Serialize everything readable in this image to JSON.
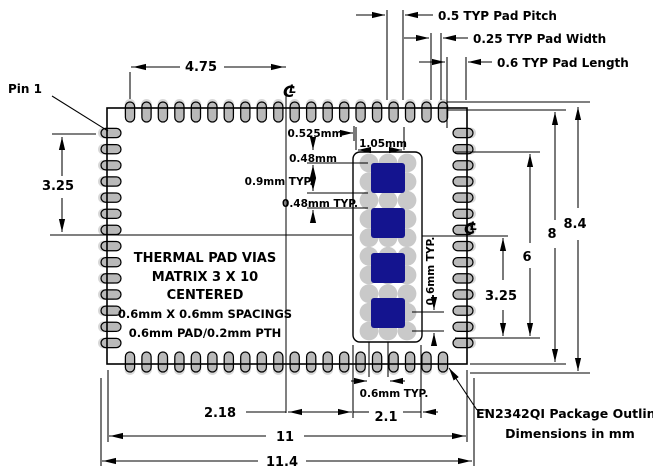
{
  "drawing": {
    "pin1_label": "Pin 1",
    "centerline_symbol": {
      "c": "C",
      "l": "L"
    },
    "outline_note": {
      "line1": "EN2342QI Package Outline",
      "line2": "Dimensions in mm"
    },
    "thermal_note": {
      "line1": "THERMAL PAD VIAS",
      "line2": "MATRIX  3 X 10",
      "line3": "CENTERED",
      "line4": "0.6mm X 0.6mm SPACINGS",
      "line5": "0.6mm PAD/0.2mm PTH"
    },
    "dims": {
      "pad_pitch": "0.5 TYP Pad Pitch",
      "pad_width": "0.25 TYP Pad Width",
      "pad_length": "0.6 TYP Pad Length",
      "top_span": "4.75",
      "left_span": "3.25",
      "right_overall": "8.4",
      "right_body": "8",
      "right_pads": "6",
      "right_half": "3.25",
      "bottom_center_offset": "2.18",
      "bottom_thermal_width": "2.1",
      "bottom_body": "11",
      "bottom_overall": "11.4",
      "via_edge": "0.525mm",
      "via_gap_top": "0.48mm",
      "via_square_height": "0.9mm TYP.",
      "via_gap_typ": "0.48mm TYP.",
      "via_square_width": "1.05mm",
      "via_pitch_vertical": "0.6mm TYP.",
      "via_pitch_bottom": "0.6mm TYP."
    },
    "package": {
      "top_pads": 20,
      "bottom_pads": 20,
      "left_pads": 14,
      "right_pads": 14,
      "via_cols": 3,
      "via_rows": 10,
      "thermal_squares": 4
    },
    "colors": {
      "pad": "#b9b9b9",
      "pad_halo": "#d9d9d9",
      "via": "#c9c9c9",
      "square": "#14148f",
      "line": "#000000"
    }
  }
}
